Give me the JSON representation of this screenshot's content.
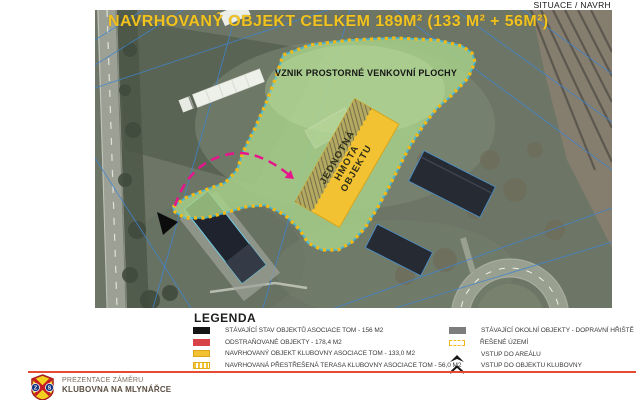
{
  "header": {
    "corner_label": "SITUACE / NAVRH"
  },
  "map": {
    "title": "NAVRHOVANÝ OBJEKT CELKEM 189M² (133 M² + 56M²)",
    "outdoor_area_label": "VZNIK PROSTORNÉ VENKOVNÍ PLOCHY",
    "building_mass_label": {
      "line1": "JEDNOTNÁ",
      "line2": "HMOTA",
      "line3": "OBJEKTU"
    }
  },
  "legend": {
    "heading": "LEGENDA",
    "left_items": [
      {
        "swatch": "black-solid",
        "label": "STÁVAJÍCÍ STAV OBJEKTŮ ASOCIACE TOM - 156 M2"
      },
      {
        "swatch": "red-solid",
        "label": "ODSTRAŇOVANÉ OBJEKTY - 178,4 M2"
      },
      {
        "swatch": "yellow-solid",
        "label": "NAVRHOVANÝ OBJEKT KLUBOVNY ASOCIACE TOM - 133,0 M2"
      },
      {
        "swatch": "yellow-hatched",
        "label": "NAVRHOVANÁ PŘESTŘEŠENÁ TERASA KLUBOVNY ASOCIACE TOM - 56,0 M2"
      }
    ],
    "right_items": [
      {
        "swatch": "gray-solid",
        "label": "STÁVAJÍCÍ OKOLNÍ OBJEKTY - DOPRAVNÍ HŘIŠTĚ"
      },
      {
        "swatch": "yellow-dashed-outline",
        "label": "ŘEŠENÉ ÚZEMÍ"
      },
      {
        "swatch": "black-arrow",
        "label": "VSTUP DO AREÁLU"
      },
      {
        "swatch": "black-chevron",
        "label": "VSTUP DO OBJEKTU KLUBOVNY"
      }
    ]
  },
  "footer": {
    "logo_letters": {
      "left": "Z",
      "right": "S"
    },
    "line1": "PREZENTACE ZÁMĚRU",
    "line2": "KLUBOVNA NA MLYNÁŘCE"
  },
  "colors": {
    "title_yellow": "#f2c21e",
    "overlay_green": "#a8d289",
    "overlay_border_cyan": "#49c4e2",
    "boundary_dotted_yellow": "#f3ba16",
    "proposed_building_yellow": "#f2c232",
    "entrance_arrow_magenta": "#e6158c",
    "legend_red": "#d8434a",
    "legend_gray": "#7d7d7d",
    "footer_rule_red": "#e64a33"
  }
}
